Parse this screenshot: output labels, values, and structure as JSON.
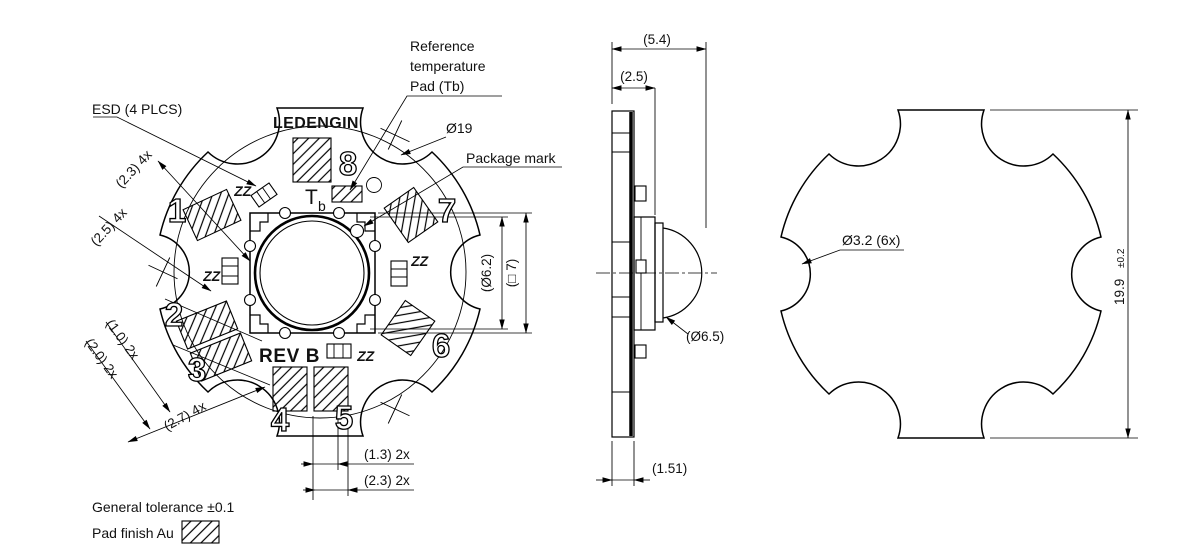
{
  "colors": {
    "ink": "#111111",
    "paper": "#ffffff"
  },
  "top_view": {
    "logo": "LEDENGIN",
    "rev": "REV B",
    "tb_main": "T",
    "tb_sub": "b",
    "zz": "ZZ",
    "esd_callout": "ESD (4 PLCS)",
    "ref_temp_line1": "Reference",
    "ref_temp_line2": "temperature",
    "ref_temp_line3": "Pad (Tb)",
    "package_mark_callout": "Package mark",
    "dia19": "Ø19",
    "pads": [
      "1",
      "2",
      "3",
      "4",
      "5",
      "6",
      "7",
      "8"
    ],
    "dims": {
      "d23_4x": "(2.3) 4x",
      "d25_4x": "(2.5) 4x",
      "d10_2x": "(1.0) 2x",
      "d20_2x": "(2.0) 2x",
      "d27_4x": "(2.7) 4x",
      "d13_2x": "(1.3) 2x",
      "d23_2x": "(2.3) 2x",
      "d62": "(Ø6.2)",
      "sq7": "(□ 7)"
    }
  },
  "side_view": {
    "dims": {
      "d54": "(5.4)",
      "d25": "(2.5)",
      "d65": "(Ø6.5)",
      "d151": "(1.51)"
    }
  },
  "outline_view": {
    "dims": {
      "d32": "Ø3.2 (6x)",
      "d199": "19.9",
      "d199_tol": "±0.2"
    }
  },
  "legend": {
    "general_tolerance": "General tolerance ±0.1",
    "pad_finish": "Pad finish Au"
  }
}
